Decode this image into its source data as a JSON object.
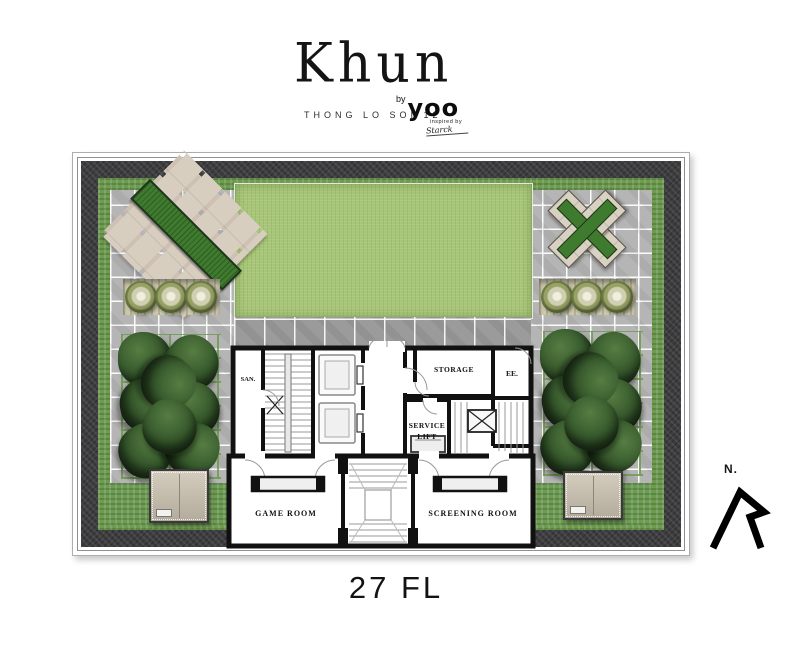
{
  "brand": {
    "name": "Khun",
    "location": "THONG LO SOI 12",
    "by_label": "by",
    "studio": "yoo",
    "tagline_line1": "inspired by",
    "tagline_line2": "Starck"
  },
  "floor": {
    "label": "27 FL"
  },
  "compass": {
    "north_label": "N."
  },
  "rooms": {
    "san": "SAN.",
    "storage": "STORAGE",
    "ee": "EE.",
    "service_line1": "SERVICE",
    "service_line2": "LIFT",
    "game_room": "GAME ROOM",
    "screening_room": "SCREENING ROOM"
  },
  "colors": {
    "lawn_green": "#a8c677",
    "hedge_green": "#6e9b50",
    "planter_green": "#3e7b2f",
    "roof_border_charcoal": "#3d3d3f",
    "tile_gray": "#b5b5b5",
    "walkway_gray": "#9b9b9b",
    "tree_green": "#33552a",
    "paver_cream": "#d7cec0",
    "wall_black": "#111111"
  }
}
